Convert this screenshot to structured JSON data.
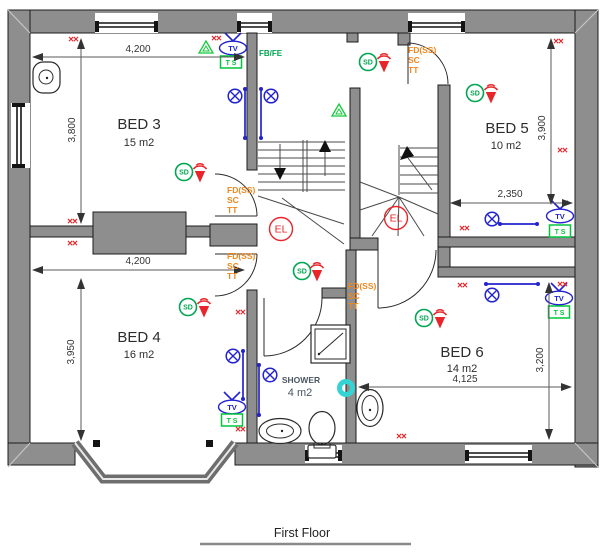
{
  "title": {
    "label": "First Floor"
  },
  "rooms": {
    "bed3": {
      "name": "BED 3",
      "area": "15 m2"
    },
    "bed4": {
      "name": "BED 4",
      "area": "16 m2"
    },
    "bed5": {
      "name": "BED 5",
      "area": "10 m2"
    },
    "bed6": {
      "name": "BED 6",
      "area": "14 m2"
    },
    "shower": {
      "name": "SHOWER",
      "area": "4 m2"
    }
  },
  "dimensions": {
    "bed3_width": "4,200",
    "bed3_depth": "3,800",
    "bed4_width": "4,200",
    "bed4_depth": "3,950",
    "bed5_depth": "3,900",
    "bed5_width": "2,350",
    "bed6_width": "4,125",
    "bed6_depth": "3,200"
  },
  "symbols": {
    "smoke_detector": "SD",
    "emergency_light": "EL",
    "tv_point": "TV",
    "tv_socket": "T S",
    "fire_blanket": "FB/FE",
    "double_cross": "××",
    "fire_door": {
      "line1": "FD(SS)",
      "line2": "SC",
      "line3": "TT"
    }
  },
  "colors": {
    "wall_grey": "#8e8e8e",
    "electrical_blue": "#2323cf",
    "safety_green": "#00a651",
    "alert_red": "#e8252a",
    "fire_door_orange": "#f0871e",
    "extract_cyan": "#35d4d4"
  }
}
